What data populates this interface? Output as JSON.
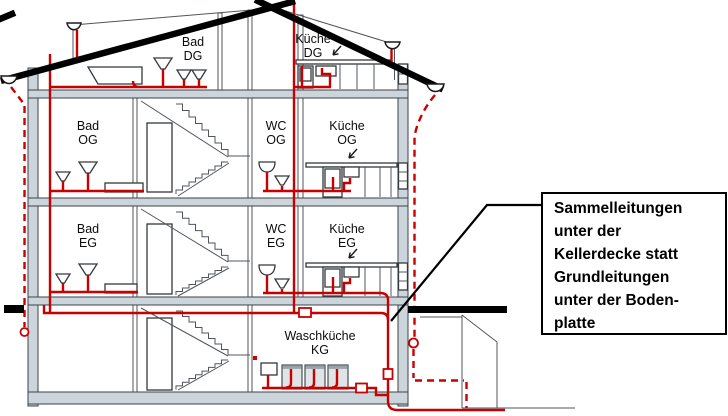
{
  "diagram": {
    "kind": "building cross-section with drainage piping",
    "rooms": {
      "bad_dg": {
        "name": "Bad",
        "floor": "DG"
      },
      "kueche_dg": {
        "name": "Küche",
        "floor": "DG"
      },
      "bad_og": {
        "name": "Bad",
        "floor": "OG"
      },
      "wc_og": {
        "name": "WC",
        "floor": "OG"
      },
      "kueche_og": {
        "name": "Küche",
        "floor": "OG"
      },
      "bad_eg": {
        "name": "Bad",
        "floor": "EG"
      },
      "wc_eg": {
        "name": "WC",
        "floor": "EG"
      },
      "kueche_eg": {
        "name": "Küche",
        "floor": "EG"
      },
      "waschkueche_kg": {
        "name": "Waschküche",
        "floor": "KG"
      }
    },
    "callout": {
      "lines": [
        "Sammelleitungen",
        "unter der",
        "Kellerdecke statt",
        "Grundleitungen",
        "unter der Boden-",
        "platte"
      ]
    }
  },
  "colors": {
    "pipe_red": "#c80000",
    "wall_fill": "#ccd5dc",
    "roof_black": "#000000",
    "callout_border": "#000000"
  }
}
